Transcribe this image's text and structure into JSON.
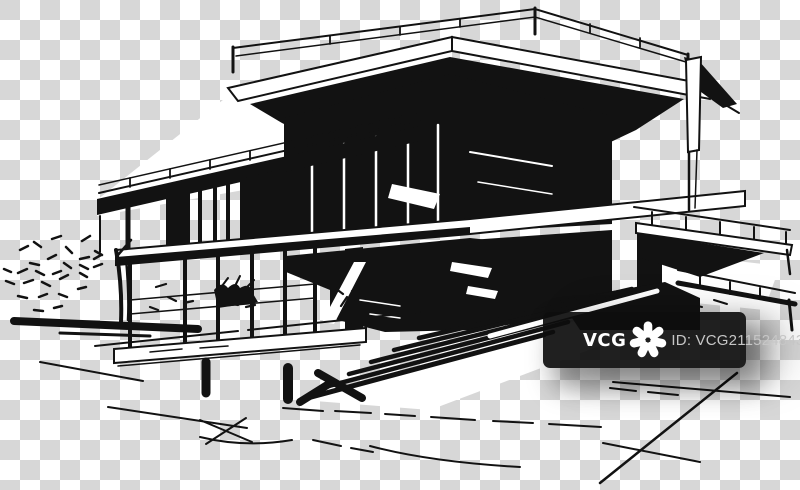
{
  "theme": {
    "checker_dark": "#d7d7d7",
    "paper": "#ffffff",
    "ink": "#121212",
    "wm_box": "rgba(13,13,13,0.92)",
    "wm_brand": "#ffffff",
    "wm_id": "#c6c6c6"
  },
  "image": {
    "description": "Black and white architectural ink sketch of a modern cantilevered two-storey house with roof terrace railing, glass walls, wide entrance stairs and a small tree, drawn on a transparent checkerboard background"
  },
  "watermark": {
    "brand": "VCG",
    "id_text": "ID: VCG211524843194",
    "logo_icon": "vcg-flower-icon"
  }
}
